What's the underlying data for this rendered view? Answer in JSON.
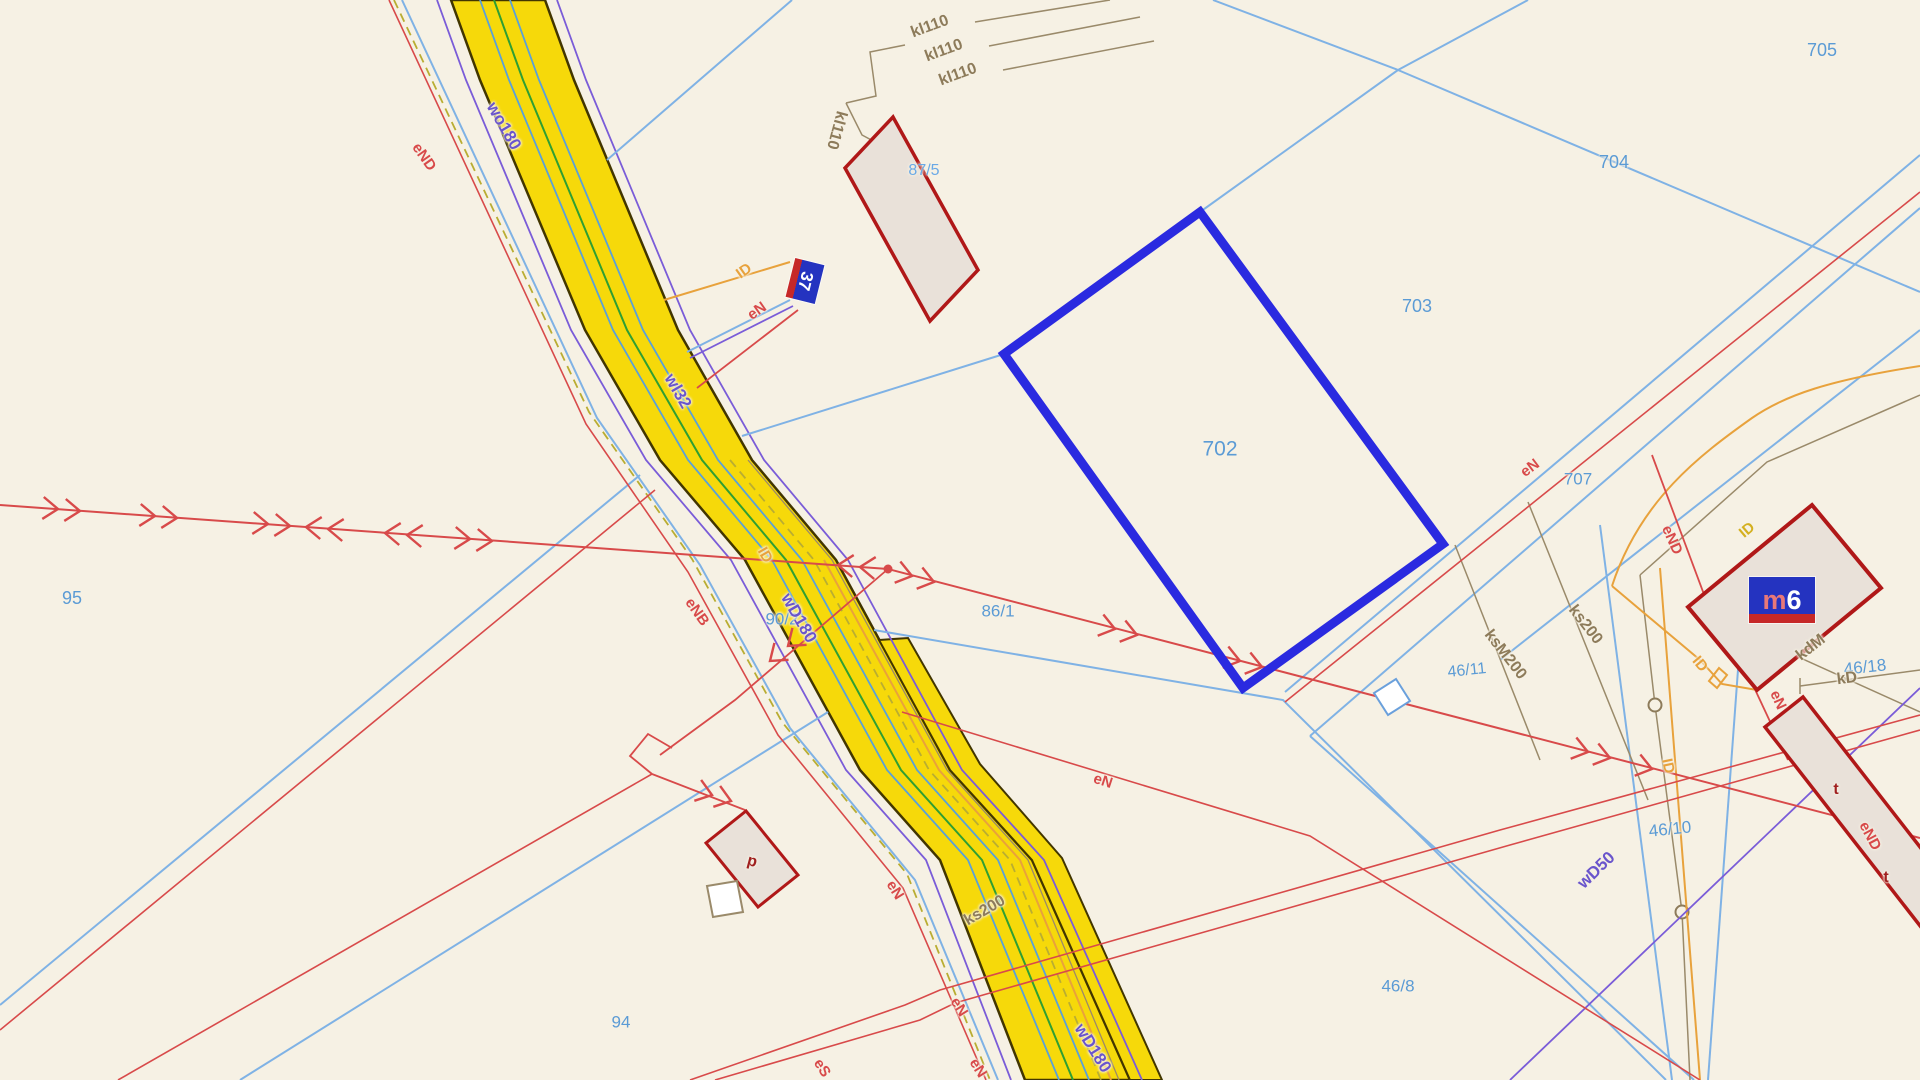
{
  "map": {
    "background": "#f6f1e4",
    "selected_parcel_number": "702",
    "colors": {
      "selection_blue": "#2a2ae0",
      "boundary_blue": "#7fb2e5",
      "parcel_label_blue": "#5b9bd5",
      "road_fill_yellow": "#f6d90a",
      "power_red": "#d84a4a",
      "water_purple": "#6a55cc",
      "lighting_orange": "#e8a23c",
      "sewer_brown": "#8d7b5a",
      "plate_blue": "#2433c0",
      "plate_red_stripe": "#c62828",
      "building_outline": "#b01818",
      "building_fill": "#e9e1d9"
    },
    "parcel_labels": {
      "n702": "702",
      "n703": "703",
      "n704": "704",
      "n705": "705",
      "n707": "707",
      "n95": "95",
      "n94": "94",
      "n90_2": "90/2",
      "n86_1": "86/1",
      "n87_5": "87/5",
      "n46_8": "46/8",
      "n46_10": "46/10",
      "n46_11": "46/11",
      "n46_18": "46/18",
      "n87_4_cut": "87/4",
      "n87_7_cut": "87/7"
    },
    "utility_labels": {
      "kl110": "kl110",
      "wo180": "wo180",
      "wl32": "wl32",
      "wD180": "wD180",
      "wD50": "wD50",
      "ks200": "ks200",
      "ksM200": "ksM200",
      "kdM": "kdM",
      "kD": "kD",
      "eN": "eN",
      "eND": "eND",
      "eNB": "eNB",
      "eS": "eS",
      "ID": "ID"
    },
    "building_labels": {
      "plate37": "37",
      "m6_letter": "m",
      "m6_number": "6",
      "p": "p",
      "t": "t"
    }
  }
}
